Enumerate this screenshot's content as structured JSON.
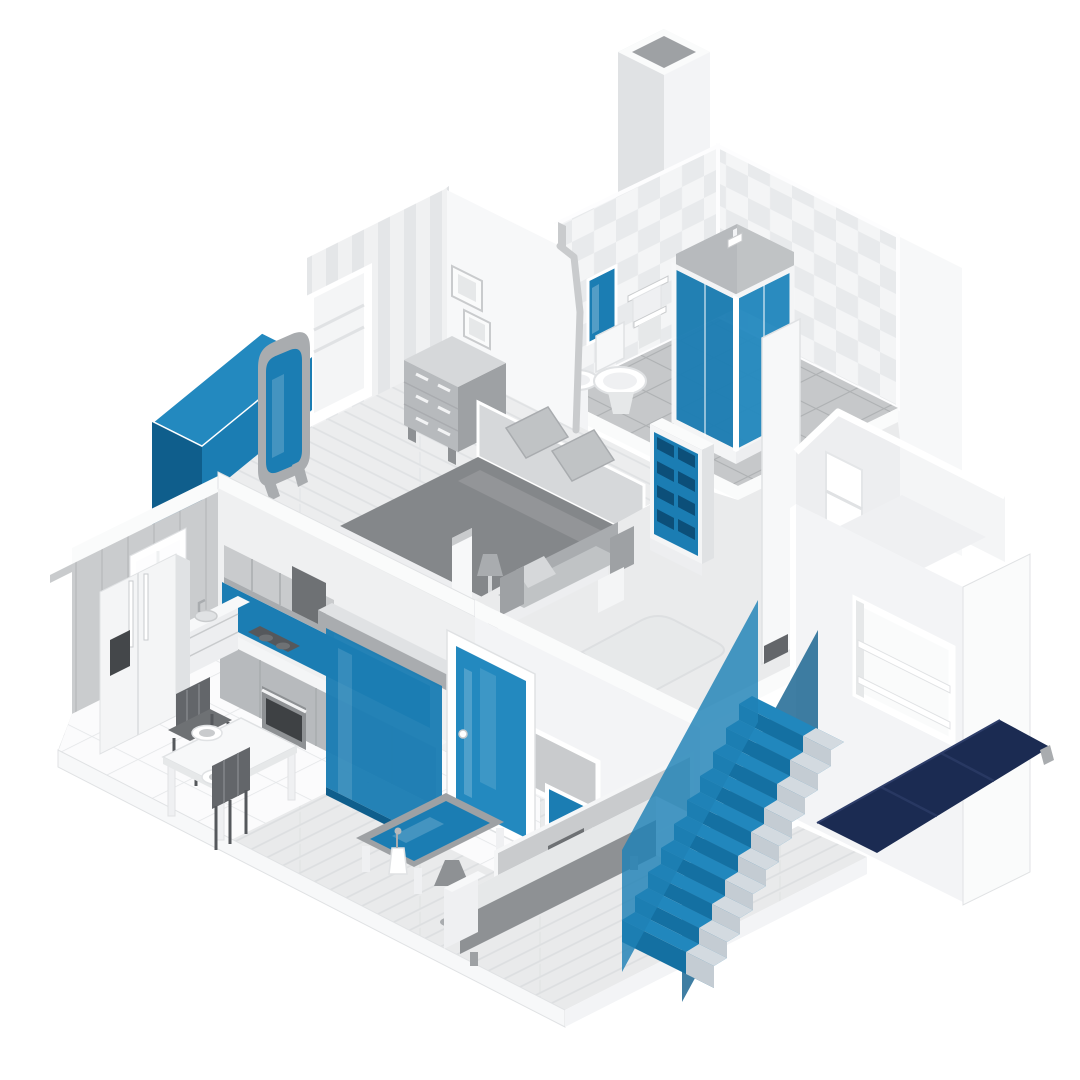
{
  "meta": {
    "type": "isometric-cutaway-house-illustration",
    "canvas": {
      "width": 1080,
      "height": 1080
    }
  },
  "colors": {
    "accent": "#1B7DB3",
    "accent_bright": "#2389BF",
    "accent_deep": "#0F5E8C",
    "accent_darkest": "#0C4F79",
    "rail_blue": "#1E81B6",
    "step_tread": "#2187BD",
    "step_riser": "#1470A2",
    "pale_tread": "#D3DAE0",
    "pale_riser": "#C4CCD3",
    "awning_navy": "#1B2B52",
    "awning_fold": "#283862",
    "white": "#FFFFFF",
    "wall_white": "#F7F8F9",
    "wall_light": "#F3F4F6",
    "wall_mid": "#EFF0F1",
    "slab": "#FAFBFB",
    "hall_floor": "#EAEBEC",
    "rug": "#E7E9EA",
    "check_base": "#F4F5F6",
    "check_cell": "#E8EAEC",
    "stripe_base": "#F0F1F2",
    "stripe_line": "#E4E6E8",
    "bath_tile": "#C6C8CA",
    "bath_tile_line": "#AEB1B3",
    "kitchen_tile": "#FBFBFC",
    "kitchen_tile_line": "#E6E8EA",
    "kitchen_wall": "#CACCCE",
    "kitchen_wall_line": "#BEC0C2",
    "wood_base": "#ECEDEE",
    "wood_line": "#E0E2E4",
    "wood2_base": "#E9EAEB",
    "wood2_line": "#DDDFE1",
    "g050": "#F4F5F6",
    "g100": "#EFF0F2",
    "g150": "#EDEEF0",
    "g200": "#E6E8E9",
    "g250": "#E0E2E4",
    "g300": "#D6D8DA",
    "g350": "#C9CBCD",
    "g400": "#C0C3C5",
    "g450": "#B7BABD",
    "g500": "#A9ACAF",
    "g550": "#9EA1A4",
    "g600": "#8E9194",
    "g650": "#84878A",
    "g700": "#6E7174",
    "g750": "#63666A",
    "g800": "#55585C",
    "g850": "#44474A",
    "g900": "#3E4144"
  },
  "scene": {
    "building": {
      "floors": [
        "ground-floor",
        "upper-floor"
      ],
      "exterior": [
        "chimney",
        "gabled-extension",
        "navy-awning"
      ]
    },
    "rooms": [
      {
        "name": "bathroom",
        "floor": "upper",
        "items": [
          "shower-enclosure-blue-glass",
          "shower-head",
          "toilet",
          "pedestal-sink",
          "blue-wall-mirror",
          "towel-rails",
          "checkered-wallpaper",
          "gray-tile-floor"
        ]
      },
      {
        "name": "bedroom",
        "floor": "upper",
        "items": [
          "double-bed",
          "pillows",
          "headboard",
          "dresser",
          "standing-mirror-blue",
          "two-wall-frames",
          "closet-doorway",
          "floor-lamp",
          "blue-roof-nook",
          "striped-wallpaper",
          "wood-floor"
        ]
      },
      {
        "name": "landing",
        "floor": "upper",
        "items": [
          "blue-bookshelf",
          "gray-sofa",
          "light-rug",
          "corner-pillar",
          "small-dark-frame"
        ]
      },
      {
        "name": "kitchen",
        "floor": "ground",
        "items": [
          "fridge",
          "window",
          "wall-cabinets",
          "range-hood",
          "blue-backsplash",
          "cooktop",
          "oven",
          "counter-drawers",
          "sink",
          "dining-table",
          "two-plates",
          "two-dark-chairs",
          "white-tile-floor"
        ]
      },
      {
        "name": "living-room",
        "floor": "ground",
        "items": [
          "blue-glass-partition",
          "blue-glass-door",
          "blue-sidelight",
          "gray-wall-art",
          "coffee-table-blue-glass",
          "vase",
          "floor-lamp",
          "white-gray-sofa",
          "wood-plank-floor"
        ]
      },
      {
        "name": "staircase",
        "floor": "ground",
        "items": [
          "blue-steps",
          "left-glass-railing",
          "right-glass-railing",
          "pale-outer-stringer"
        ]
      },
      {
        "name": "extension",
        "floor": "both",
        "items": [
          "gable-wall",
          "gable-window",
          "open-window-with-shelves",
          "navy-awning",
          "awning-bracket"
        ]
      }
    ]
  }
}
